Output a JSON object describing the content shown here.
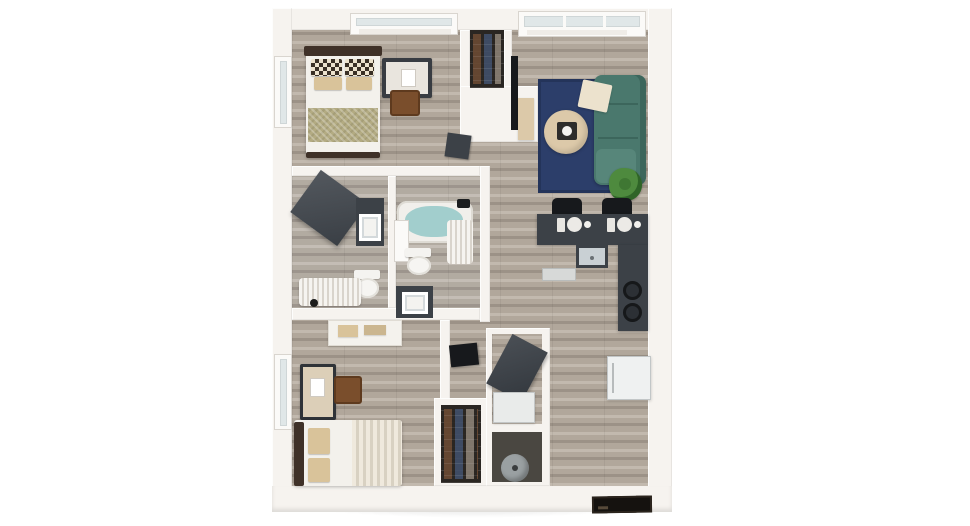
{
  "scene": {
    "type": "3d-apartment-floor-plan-render",
    "view": "top-down",
    "background": "#ffffff",
    "text_visible": false
  },
  "colors": {
    "wall": "#f6f3ef",
    "wallShade": "#e6e1da",
    "floor": "#b1a79b",
    "floorLight": "#c2b9ae",
    "floorDark": "#9c9287",
    "glass": "#e0e7e8",
    "rug": "#2c3e6a",
    "rugBorder": "#24345a",
    "sofa": "#4a786d",
    "sofaLight": "#57867a",
    "sofaDark": "#3c665c",
    "table": "#dcc9a9",
    "tray": "#2e2d2b",
    "plant": "#4e8a3e",
    "plantDark": "#2f6428",
    "pot": "#3a3a38",
    "charcoal": "#3c4147",
    "black": "#17191c",
    "whiteFab": "#f3f1ec",
    "cream": "#ece2cd",
    "tan": "#d9c39a",
    "olive": "#b3ab82",
    "checkDark": "#3a3026",
    "headboard": "#3f3128",
    "woodBrown": "#7a4e2c",
    "tealWater": "#a2cecd",
    "fixture": "#f1efeb",
    "sinkGray": "#c9d0d4",
    "appliance": "#eff1f1",
    "closet": "#2a2622",
    "shoeBrown": "#6b4a33",
    "shoeBlue": "#41506b",
    "shoeGray": "#8a8075",
    "utilFloor": "#4a4741",
    "heater": "#9aa0a2",
    "mat": "#15120f"
  },
  "rooms": [
    {
      "id": "bedroom-1",
      "area": "top-left"
    },
    {
      "id": "closet-top",
      "area": "top-middle"
    },
    {
      "id": "living-room",
      "area": "top-right"
    },
    {
      "id": "bathroom-a",
      "area": "mid-left"
    },
    {
      "id": "bathroom-b",
      "area": "mid-center"
    },
    {
      "id": "kitchen",
      "area": "mid-right"
    },
    {
      "id": "bedroom-2",
      "area": "bottom-left"
    },
    {
      "id": "closet-shoes",
      "area": "bottom-middle"
    },
    {
      "id": "utility-laundry",
      "area": "bottom-center"
    },
    {
      "id": "entry",
      "area": "bottom-right"
    }
  ],
  "furniture": [
    "bed-1",
    "headboard-1",
    "checkered-pillows",
    "tan-pillows",
    "olive-throw",
    "desk",
    "desk-chair",
    "dark-dresser",
    "wall-tv-living",
    "media-console",
    "area-rug",
    "sectional-sofa",
    "throw-blanket",
    "round-coffee-table",
    "serving-tray",
    "potted-plant",
    "bar-counter",
    "bar-stool",
    "place-setting",
    "kitchen-sink",
    "dishwasher",
    "cooktop-burners",
    "refrigerator",
    "sliding-door-dark",
    "vanity-sink-a",
    "toilet-a",
    "tub-curtain-a",
    "bathtub-b",
    "shower-curtain-b",
    "shower-head",
    "toilet-b",
    "vanity-sink-b",
    "dresser-2",
    "nightstand-2",
    "chair-2",
    "bed-2",
    "wall-tv-bedroom2",
    "shoe-rack-top",
    "shoe-rack-bottom",
    "washer",
    "water-heater",
    "entry-door-mat"
  ]
}
